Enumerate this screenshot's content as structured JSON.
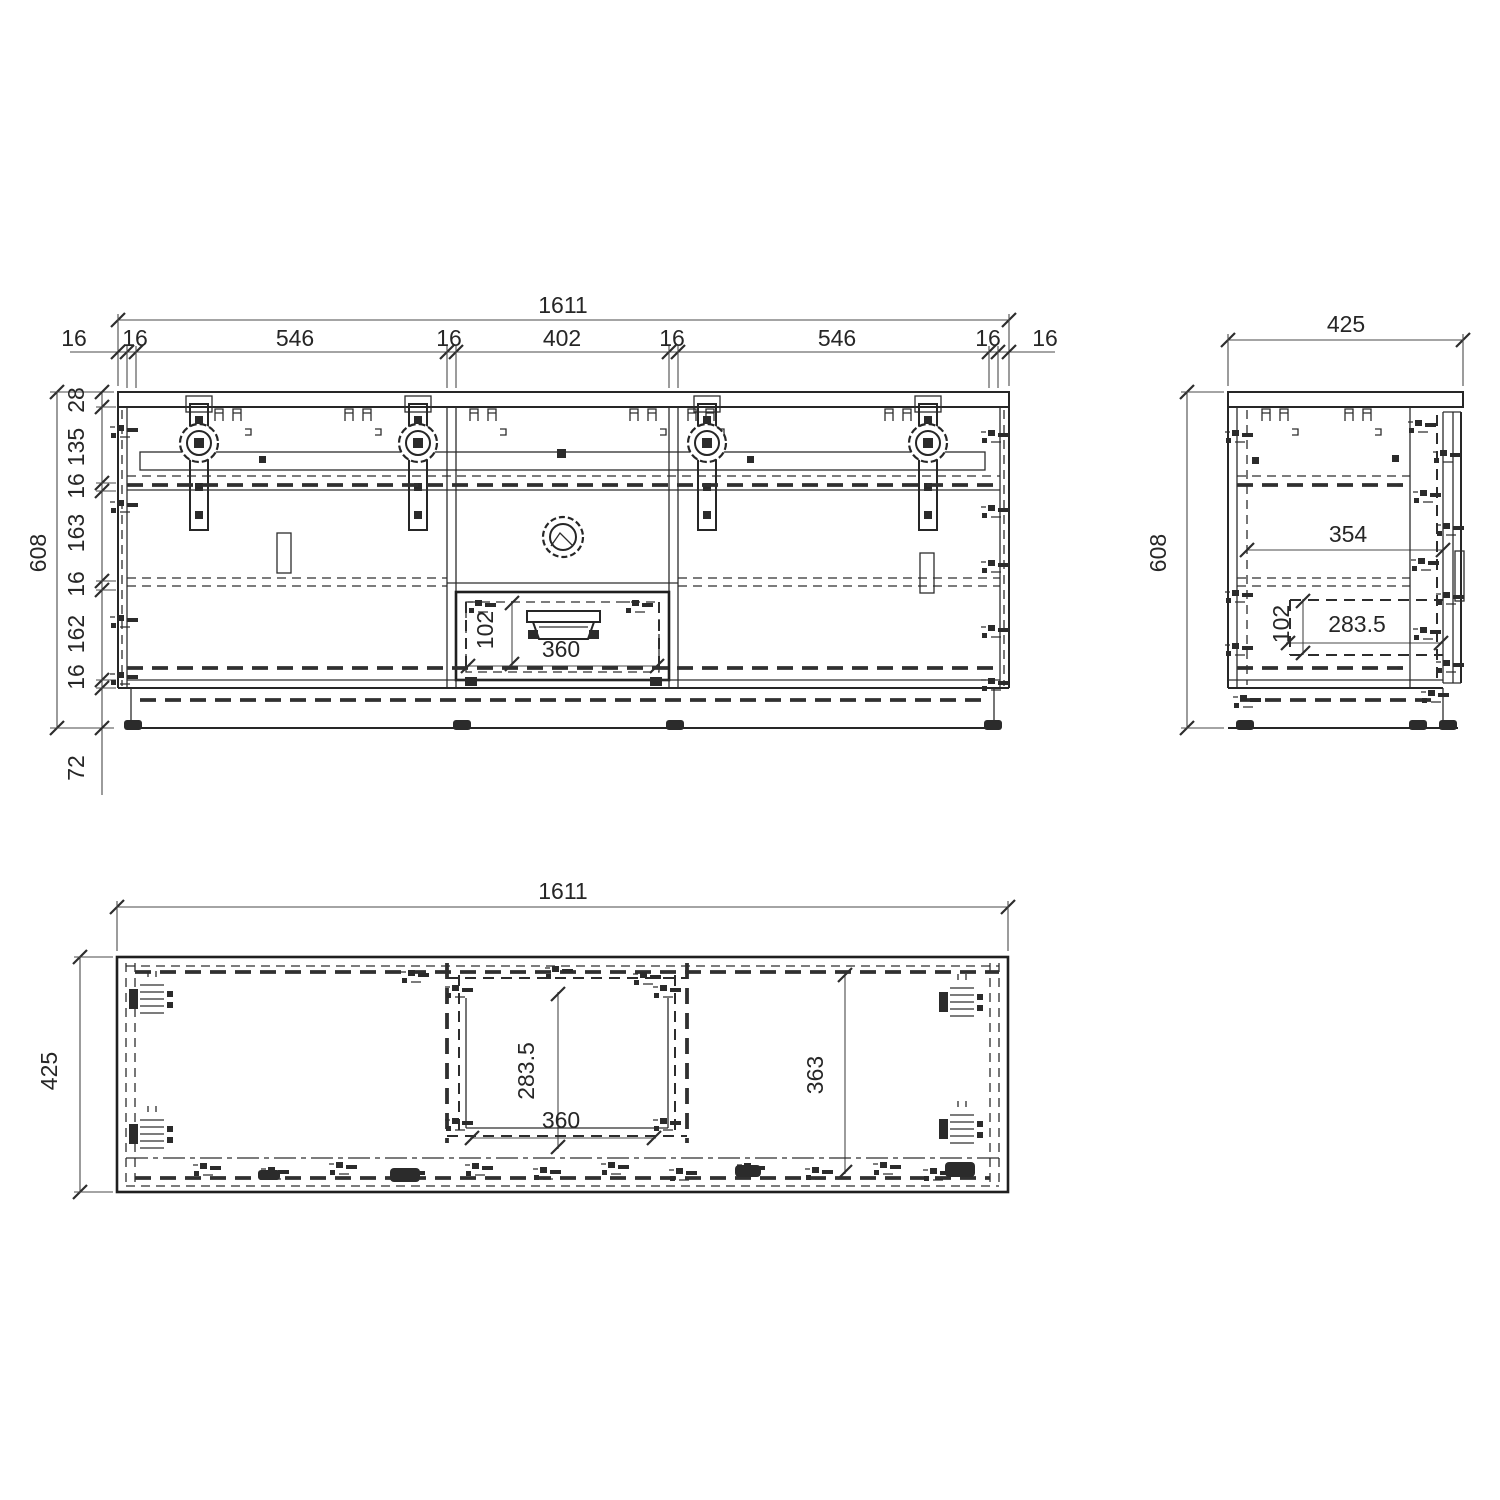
{
  "front_view": {
    "total_width": "1611",
    "width_chain": [
      "16",
      "16",
      "546",
      "16",
      "402",
      "16",
      "546",
      "16",
      "16"
    ],
    "total_height": "608",
    "height_chain": [
      "28",
      "135",
      "16",
      "163",
      "16",
      "162",
      "16"
    ],
    "plinth_height": "72",
    "drawer_front_height": "102",
    "drawer_opening_width": "360"
  },
  "side_view": {
    "total_depth": "425",
    "total_height": "608",
    "inner_depth": "354",
    "drawer_depth": "283.5",
    "drawer_height": "102"
  },
  "plan_view": {
    "total_width": "1611",
    "total_depth": "425",
    "drawer_inner_depth": "283.5",
    "drawer_inner_width": "360",
    "compartment_depth": "363"
  }
}
